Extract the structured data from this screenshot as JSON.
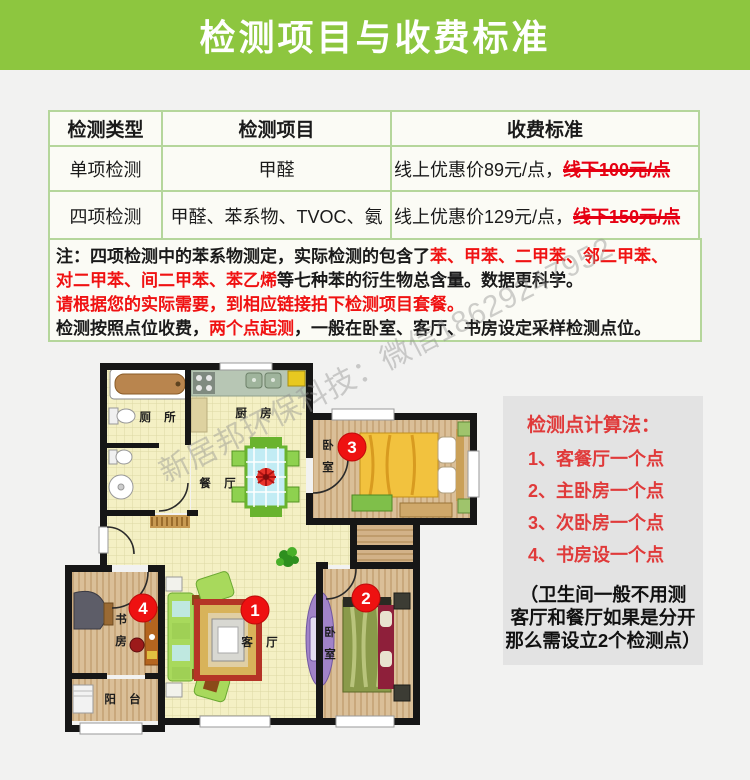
{
  "header": {
    "title": "检测项目与收费标准",
    "bg_color": "#8dc63f"
  },
  "table": {
    "columns": [
      "检测类型",
      "检测项目",
      "收费标准"
    ],
    "rows": [
      {
        "type": "单项检测",
        "items": "甲醛",
        "fee_online": "线上优惠价89元/点，",
        "fee_offline": "线下100元/点"
      },
      {
        "type": "四项检测",
        "items": "甲醛、苯系物、TVOC、氨",
        "fee_online": "线上优惠价129元/点，",
        "fee_offline": "线下150元/点"
      }
    ],
    "border_color": "#b5d69b"
  },
  "note": {
    "line1_black": "注：四项检测中的苯系物测定，实际检测的包含了",
    "line1_red": "苯、甲苯、二甲苯、邻二甲苯、",
    "line2_red": "对二甲苯、间二甲苯、苯乙烯",
    "line2_black": "等七种苯的衍生物总含量。数据更科学。",
    "line3_red": "请根据您的实际需要，到相应链接拍下检测项目套餐。",
    "line4_black1": "检测按照点位收费，",
    "line4_red": "两个点起测",
    "line4_black2": "，一般在卧室、客厅、书房设定采样检测点位。"
  },
  "panel": {
    "title": "检测点计算法：",
    "items": [
      "1、客餐厅一个点",
      "2、主卧房一个点",
      "3、次卧房一个点",
      "4、书房设一个点"
    ],
    "footnote": [
      "（卫生间一般不用测",
      "客厅和餐厅如果是分开",
      "那么需设立2个检测点）"
    ],
    "accent_color": "#e03a3a"
  },
  "floorplan": {
    "rooms": {
      "toilet": "厕 所",
      "kitchen": "厨 房",
      "dining": "餐 厅",
      "living": "客 厅",
      "balcony": "阳 台",
      "bedroom3": [
        "卧",
        "室"
      ],
      "bedroom2": [
        "卧",
        "室"
      ],
      "study": [
        "书",
        "房"
      ]
    },
    "markers": [
      {
        "number": "1",
        "room": "客厅"
      },
      {
        "number": "2",
        "room": "卧室"
      },
      {
        "number": "3",
        "room": "卧室"
      },
      {
        "number": "4",
        "room": "书房"
      }
    ],
    "marker_color": "#ee1111"
  },
  "watermark": {
    "text": "新居邦环保科技：微信18629247952"
  }
}
